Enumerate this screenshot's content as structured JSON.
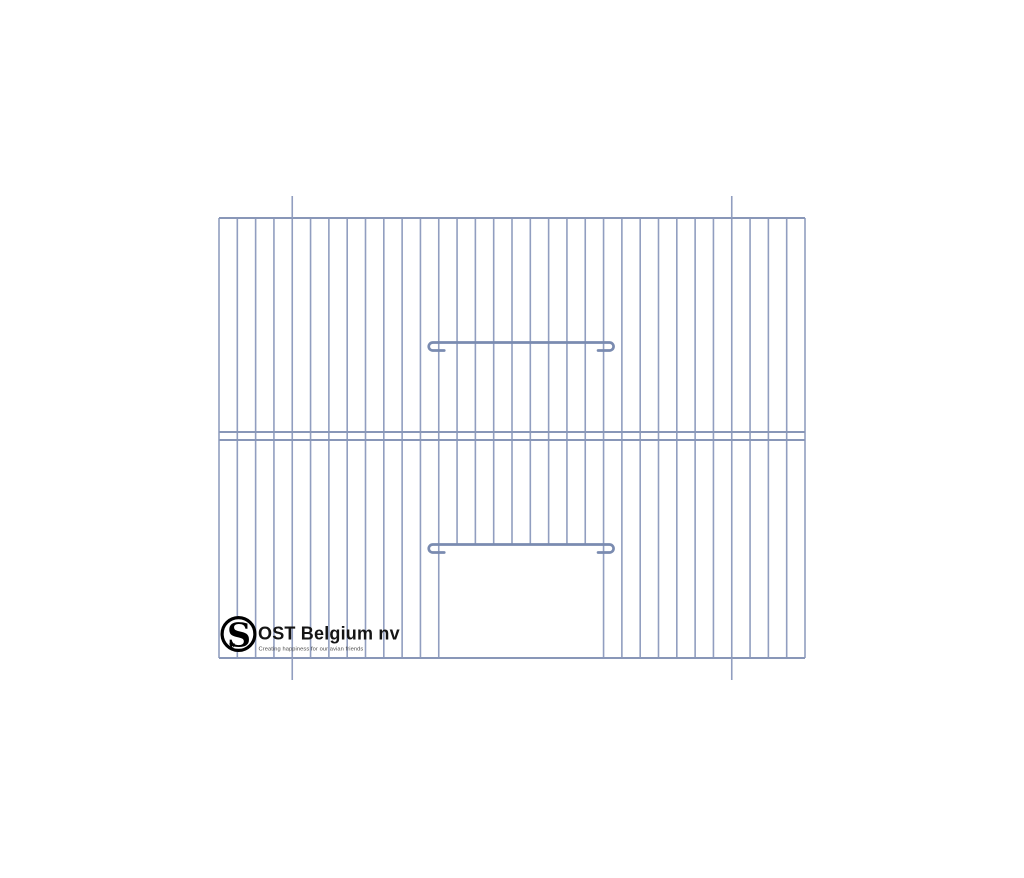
{
  "page": {
    "background": "#ffffff"
  },
  "logo": {
    "monogram": "S",
    "monogram_accent": "v",
    "company": "OST Belgium nv",
    "tagline": "Creating happiness for our avian friends",
    "colors": {
      "mark": "#000000",
      "company": "#141414",
      "tagline": "#4a4a4a"
    }
  },
  "drawing": {
    "label": "bird-cage-front-panel-technical-drawing",
    "colors": {
      "wire": "#919ec0",
      "rail": "#8997b8",
      "bar": "#7a8bb0"
    },
    "panel": {
      "left": 219,
      "top": 218,
      "right": 805,
      "bottom": 658
    },
    "vertical_wires": {
      "count": 33,
      "width": 1.6
    },
    "rails": {
      "top_y": 218,
      "middle_ys": [
        432,
        440
      ],
      "bottom_y": 658,
      "width": 2
    },
    "door": {
      "left_wire": 12,
      "right_wire": 21,
      "bar_y": 544.5
    },
    "slide_bar": {
      "y": 342.5
    },
    "hooks": {
      "side": 6,
      "drop": 8,
      "tail": 5.5,
      "width": 2.7
    },
    "fold_marks": {
      "wire_indices": [
        4,
        28
      ],
      "extension": 22,
      "width": 1.6
    }
  }
}
